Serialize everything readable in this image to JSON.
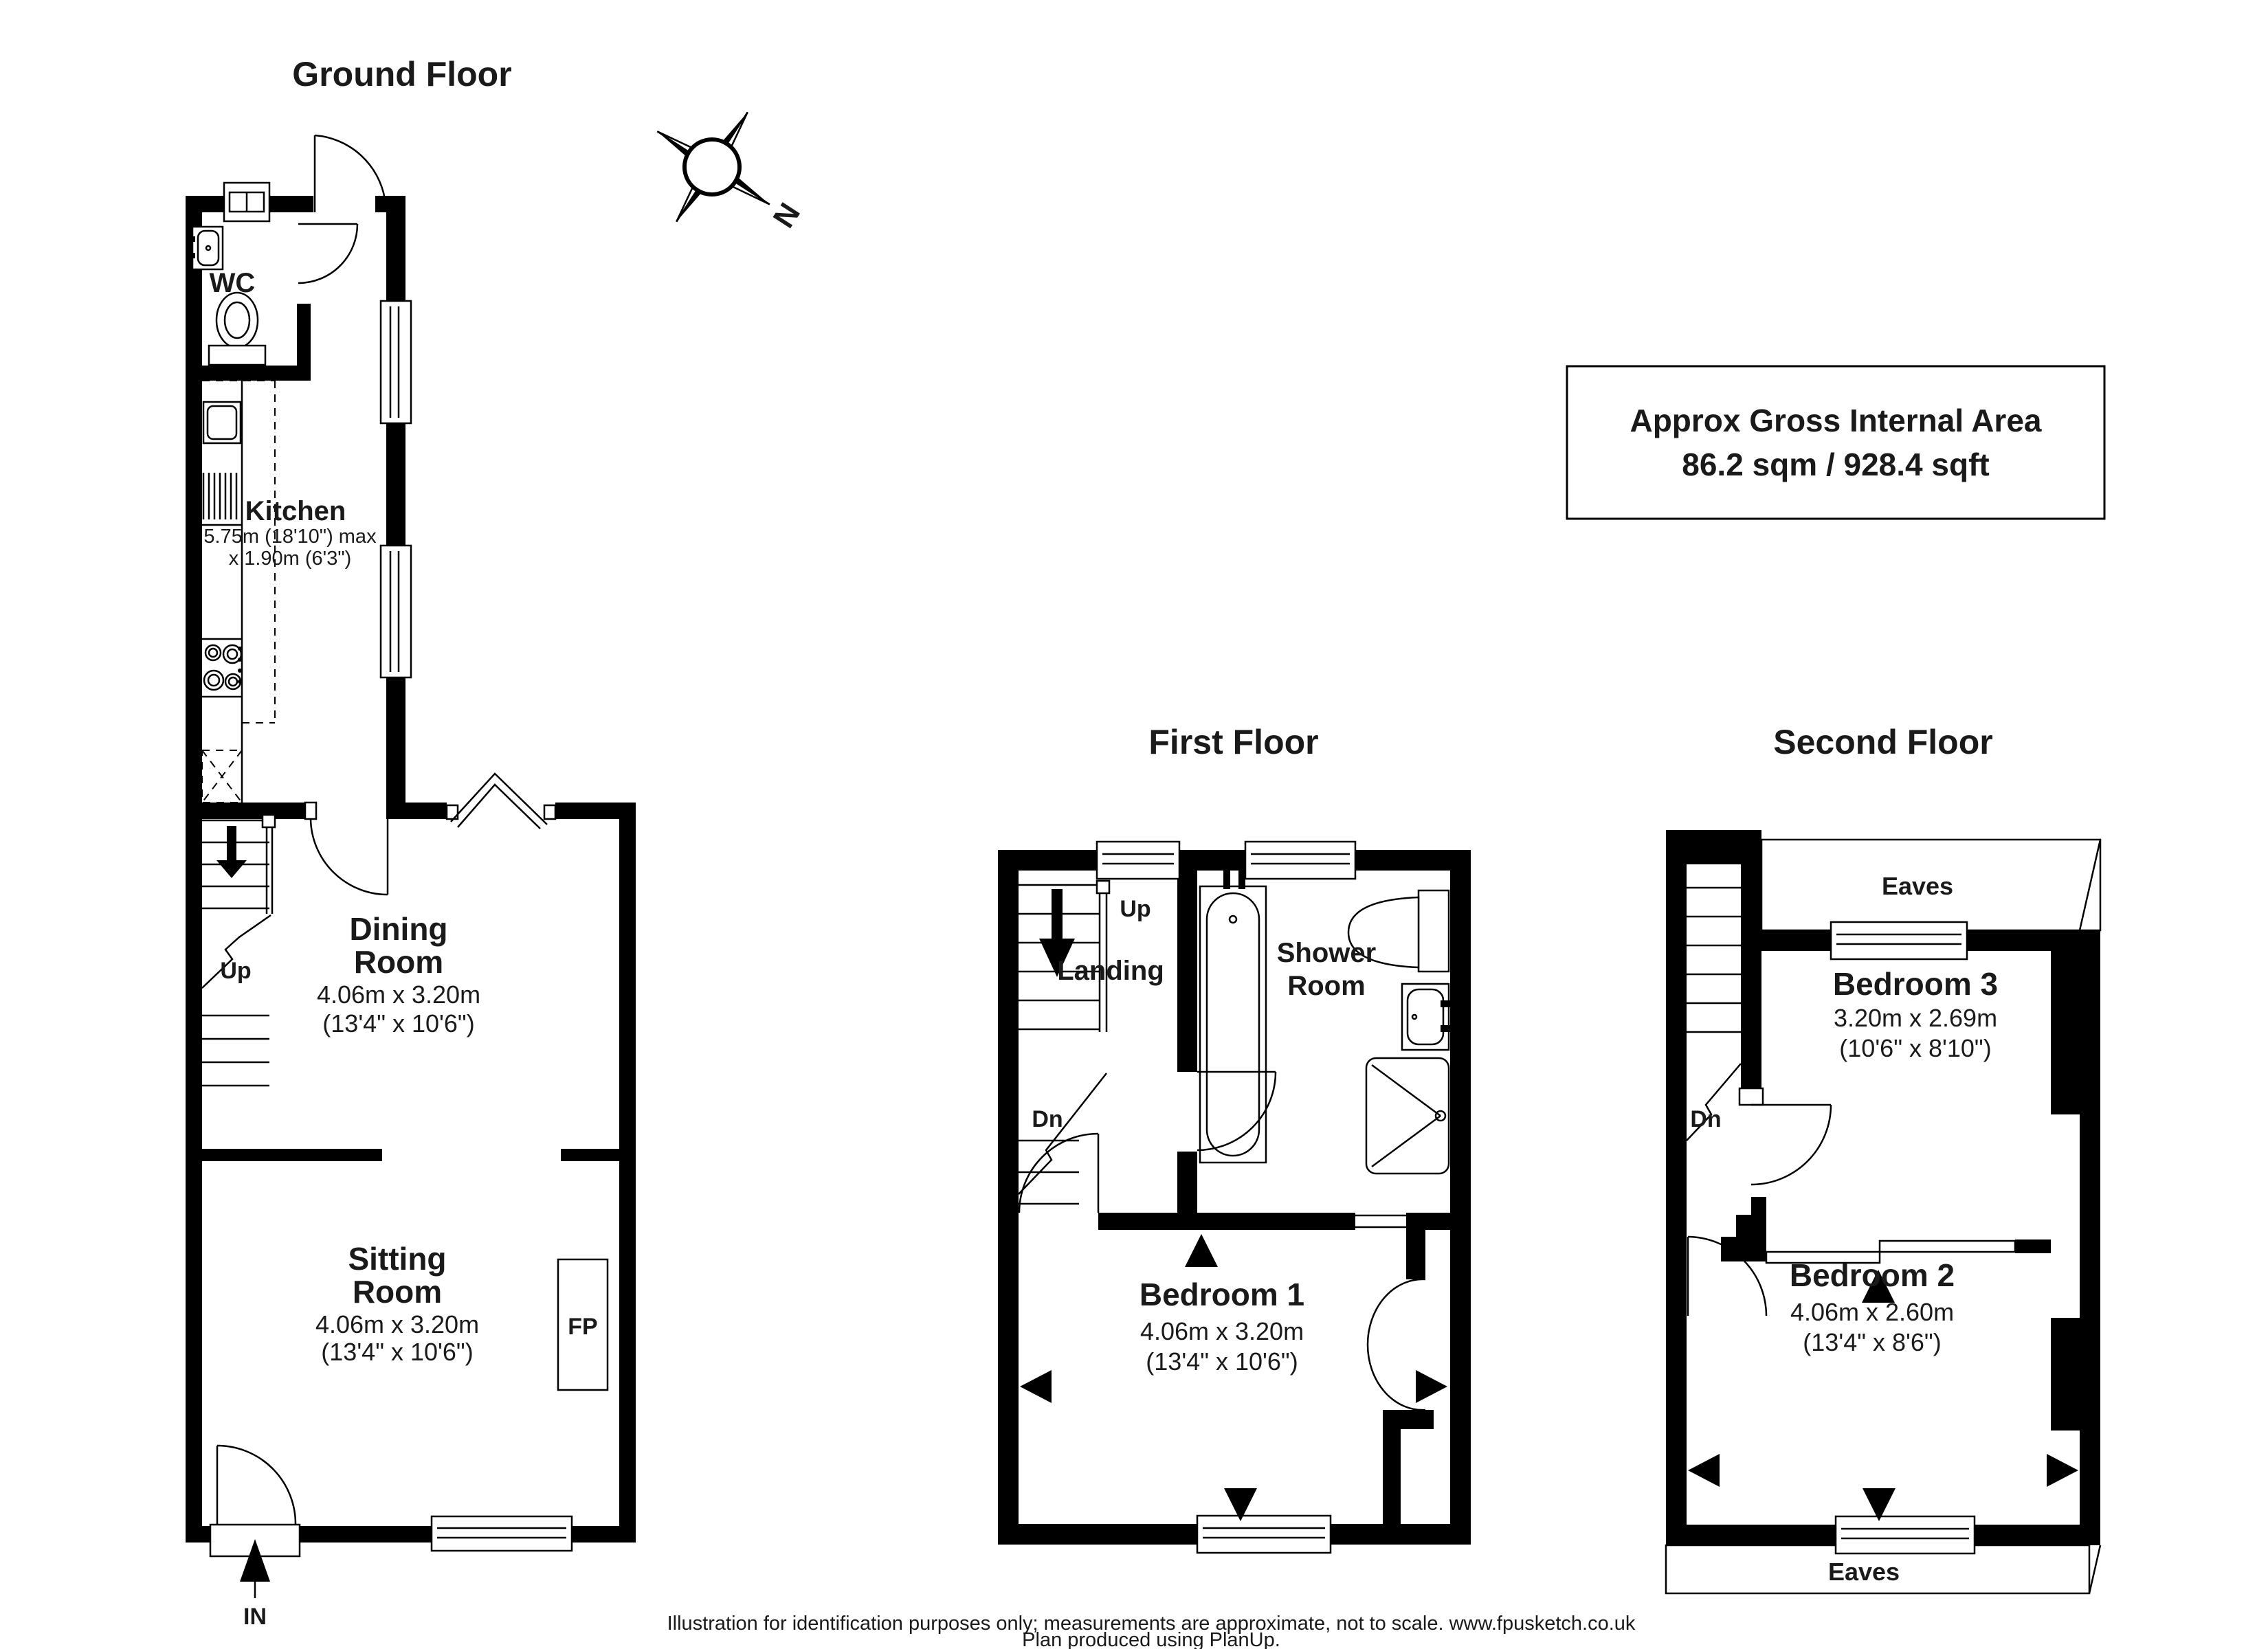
{
  "area_box": {
    "line1": "Approx Gross Internal Area",
    "line2": "86.2 sqm / 928.4 sqft"
  },
  "compass": {
    "north": "N"
  },
  "floors": {
    "ground": {
      "title": "Ground Floor",
      "rooms": {
        "wc": {
          "name": "WC"
        },
        "kitchen": {
          "name": "Kitchen",
          "dim1": "5.75m (18'10\") max",
          "dim2": "x 1.90m (6'3\")"
        },
        "dining": {
          "name1": "Dining",
          "name2": "Room",
          "dim1": "4.06m x 3.20m",
          "dim2": "(13'4\" x 10'6\")"
        },
        "sitting": {
          "name1": "Sitting",
          "name2": "Room",
          "dim1": "4.06m x 3.20m",
          "dim2": "(13'4\" x 10'6\")"
        }
      },
      "labels": {
        "up": "Up",
        "in": "IN",
        "fp": "FP"
      }
    },
    "first": {
      "title": "First Floor",
      "rooms": {
        "landing": {
          "name": "Landing"
        },
        "shower": {
          "name1": "Shower",
          "name2": "Room"
        },
        "bedroom1": {
          "name": "Bedroom 1",
          "dim1": "4.06m x 3.20m",
          "dim2": "(13'4\" x 10'6\")"
        }
      },
      "labels": {
        "up": "Up",
        "dn": "Dn"
      }
    },
    "second": {
      "title": "Second Floor",
      "rooms": {
        "bedroom3": {
          "name": "Bedroom 3",
          "dim1": "3.20m x 2.69m",
          "dim2": "(10'6\" x 8'10\")"
        },
        "bedroom2": {
          "name": "Bedroom 2",
          "dim1": "4.06m x 2.60m",
          "dim2": "(13'4\" x 8'6\")"
        }
      },
      "labels": {
        "dn": "Dn",
        "eaves_top": "Eaves",
        "eaves_bottom": "Eaves"
      }
    }
  },
  "footer": {
    "line1": "Illustration for identification purposes only; measurements are approximate, not to scale. www.fpusketch.co.uk",
    "line2": "Plan produced using PlanUp."
  }
}
